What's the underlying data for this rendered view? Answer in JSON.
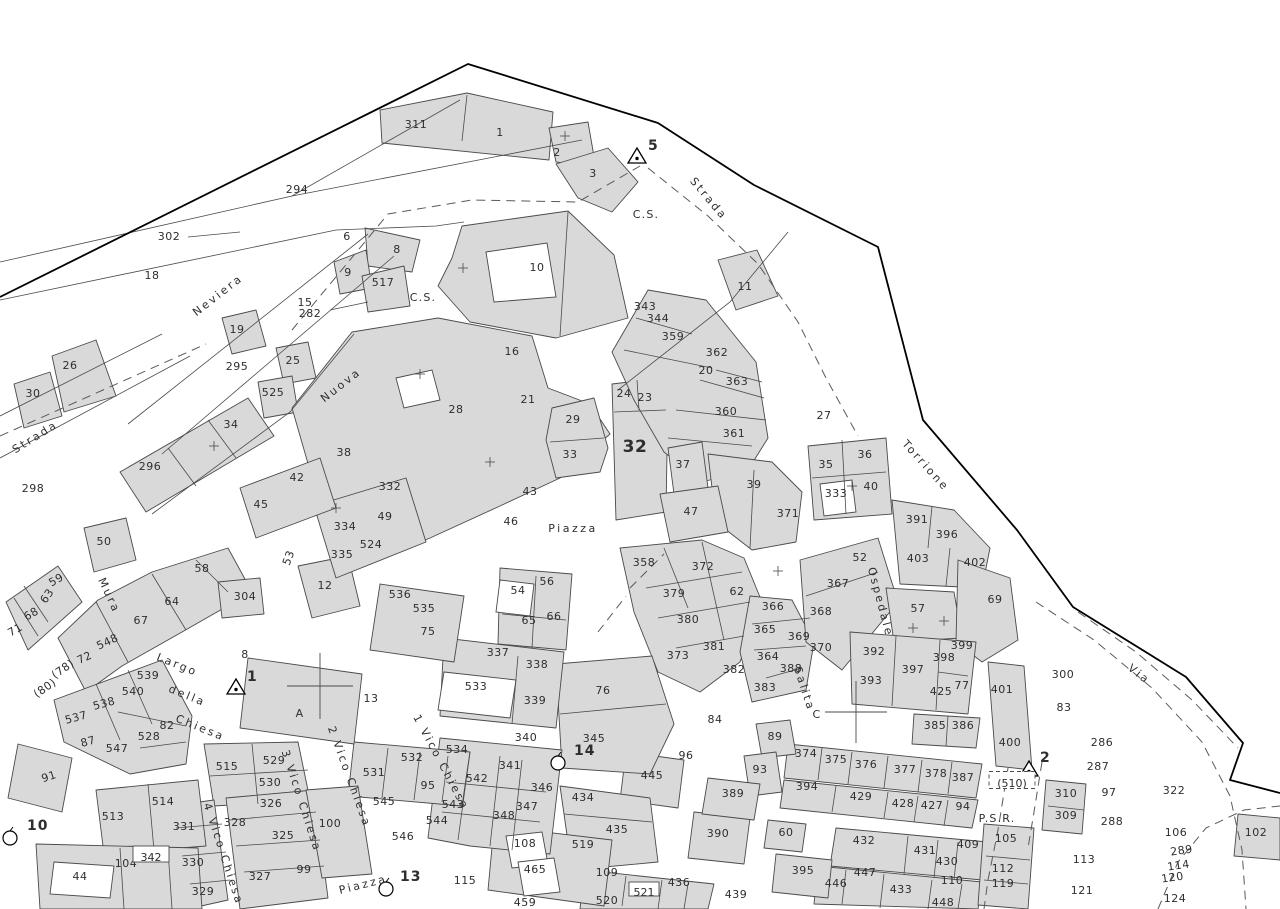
{
  "map": {
    "kind": "cadastral-sheet",
    "colors": {
      "background": "#ffffff",
      "parcel_fill": "#d9d9d9",
      "parcel_line": "#4a4a4a",
      "boundary": "#000000",
      "text": "#2e2e2e",
      "dashed_line": "#5a5a5a"
    },
    "parcel_labels": [
      {
        "t": "311",
        "x": 416,
        "y": 128
      },
      {
        "t": "1",
        "x": 500,
        "y": 136
      },
      {
        "t": "2",
        "x": 557,
        "y": 156
      },
      {
        "t": "3",
        "x": 593,
        "y": 177
      },
      {
        "t": "294",
        "x": 297,
        "y": 193
      },
      {
        "t": "302",
        "x": 169,
        "y": 240
      },
      {
        "t": "18",
        "x": 152,
        "y": 279
      },
      {
        "t": "6",
        "x": 347,
        "y": 240
      },
      {
        "t": "8",
        "x": 397,
        "y": 253
      },
      {
        "t": "9",
        "x": 348,
        "y": 276
      },
      {
        "t": "517",
        "x": 383,
        "y": 286
      },
      {
        "t": "15",
        "x": 305,
        "y": 306
      },
      {
        "t": "282",
        "x": 310,
        "y": 317
      },
      {
        "t": "10",
        "x": 537,
        "y": 271
      },
      {
        "t": "11",
        "x": 745,
        "y": 290
      },
      {
        "t": "19",
        "x": 237,
        "y": 333
      },
      {
        "t": "295",
        "x": 237,
        "y": 370
      },
      {
        "t": "25",
        "x": 293,
        "y": 364
      },
      {
        "t": "525",
        "x": 273,
        "y": 396
      },
      {
        "t": "26",
        "x": 70,
        "y": 369
      },
      {
        "t": "30",
        "x": 33,
        "y": 397
      },
      {
        "t": "34",
        "x": 231,
        "y": 428
      },
      {
        "t": "16",
        "x": 512,
        "y": 355
      },
      {
        "t": "21",
        "x": 528,
        "y": 403
      },
      {
        "t": "28",
        "x": 456,
        "y": 413
      },
      {
        "t": "29",
        "x": 573,
        "y": 423
      },
      {
        "t": "33",
        "x": 570,
        "y": 458
      },
      {
        "t": "24",
        "x": 624,
        "y": 397
      },
      {
        "t": "23",
        "x": 645,
        "y": 401
      },
      {
        "t": "343",
        "x": 645,
        "y": 310
      },
      {
        "t": "344",
        "x": 658,
        "y": 322
      },
      {
        "t": "359",
        "x": 673,
        "y": 340
      },
      {
        "t": "362",
        "x": 717,
        "y": 356
      },
      {
        "t": "20",
        "x": 706,
        "y": 374
      },
      {
        "t": "363",
        "x": 737,
        "y": 385
      },
      {
        "t": "360",
        "x": 726,
        "y": 415
      },
      {
        "t": "361",
        "x": 734,
        "y": 437
      },
      {
        "t": "27",
        "x": 824,
        "y": 419
      },
      {
        "t": "32",
        "x": 635,
        "y": 452,
        "big": true
      },
      {
        "t": "37",
        "x": 683,
        "y": 468
      },
      {
        "t": "39",
        "x": 754,
        "y": 488
      },
      {
        "t": "35",
        "x": 826,
        "y": 468
      },
      {
        "t": "36",
        "x": 865,
        "y": 458
      },
      {
        "t": "333",
        "x": 836,
        "y": 497
      },
      {
        "t": "40",
        "x": 871,
        "y": 490
      },
      {
        "t": "38",
        "x": 344,
        "y": 456
      },
      {
        "t": "42",
        "x": 297,
        "y": 481
      },
      {
        "t": "45",
        "x": 261,
        "y": 508
      },
      {
        "t": "296",
        "x": 150,
        "y": 470
      },
      {
        "t": "298",
        "x": 33,
        "y": 492
      },
      {
        "t": "332",
        "x": 390,
        "y": 490
      },
      {
        "t": "49",
        "x": 385,
        "y": 520
      },
      {
        "t": "334",
        "x": 345,
        "y": 530
      },
      {
        "t": "524",
        "x": 371,
        "y": 548
      },
      {
        "t": "335",
        "x": 342,
        "y": 558
      },
      {
        "t": "53",
        "x": 292,
        "y": 559,
        "r": -70
      },
      {
        "t": "12",
        "x": 325,
        "y": 589
      },
      {
        "t": "50",
        "x": 104,
        "y": 545
      },
      {
        "t": "59",
        "x": 58,
        "y": 583,
        "r": -30
      },
      {
        "t": "63",
        "x": 50,
        "y": 598,
        "r": -55
      },
      {
        "t": "68",
        "x": 33,
        "y": 617,
        "r": -30
      },
      {
        "t": "71",
        "x": 17,
        "y": 633,
        "r": -30
      },
      {
        "t": "58",
        "x": 202,
        "y": 572
      },
      {
        "t": "64",
        "x": 172,
        "y": 605
      },
      {
        "t": "304",
        "x": 245,
        "y": 600
      },
      {
        "t": "67",
        "x": 141,
        "y": 624
      },
      {
        "t": "548",
        "x": 109,
        "y": 645,
        "r": -25
      },
      {
        "t": "72",
        "x": 86,
        "y": 661,
        "r": -25
      },
      {
        "t": "(78)",
        "x": 65,
        "y": 672,
        "r": -35
      },
      {
        "t": "(80)",
        "x": 47,
        "y": 691,
        "r": -35
      },
      {
        "t": "43",
        "x": 530,
        "y": 495
      },
      {
        "t": "46",
        "x": 511,
        "y": 525
      },
      {
        "t": "47",
        "x": 691,
        "y": 515
      },
      {
        "t": "371",
        "x": 788,
        "y": 517
      },
      {
        "t": "358",
        "x": 644,
        "y": 566
      },
      {
        "t": "372",
        "x": 703,
        "y": 570
      },
      {
        "t": "62",
        "x": 737,
        "y": 595
      },
      {
        "t": "379",
        "x": 674,
        "y": 597
      },
      {
        "t": "380",
        "x": 688,
        "y": 623
      },
      {
        "t": "381",
        "x": 714,
        "y": 650
      },
      {
        "t": "373",
        "x": 678,
        "y": 659
      },
      {
        "t": "382",
        "x": 734,
        "y": 673
      },
      {
        "t": "388",
        "x": 791,
        "y": 672
      },
      {
        "t": "383",
        "x": 765,
        "y": 691
      },
      {
        "t": "364",
        "x": 768,
        "y": 660
      },
      {
        "t": "365",
        "x": 765,
        "y": 633
      },
      {
        "t": "366",
        "x": 773,
        "y": 610
      },
      {
        "t": "369",
        "x": 799,
        "y": 640
      },
      {
        "t": "370",
        "x": 821,
        "y": 651
      },
      {
        "t": "368",
        "x": 821,
        "y": 615
      },
      {
        "t": "367",
        "x": 838,
        "y": 587
      },
      {
        "t": "52",
        "x": 860,
        "y": 561
      },
      {
        "t": "57",
        "x": 918,
        "y": 612
      },
      {
        "t": "69",
        "x": 995,
        "y": 603
      },
      {
        "t": "391",
        "x": 917,
        "y": 523
      },
      {
        "t": "396",
        "x": 947,
        "y": 538
      },
      {
        "t": "403",
        "x": 918,
        "y": 562
      },
      {
        "t": "402",
        "x": 975,
        "y": 566
      },
      {
        "t": "392",
        "x": 874,
        "y": 655
      },
      {
        "t": "397",
        "x": 913,
        "y": 673
      },
      {
        "t": "393",
        "x": 871,
        "y": 684
      },
      {
        "t": "399",
        "x": 962,
        "y": 649
      },
      {
        "t": "398",
        "x": 944,
        "y": 661
      },
      {
        "t": "425",
        "x": 941,
        "y": 695
      },
      {
        "t": "77",
        "x": 962,
        "y": 689
      },
      {
        "t": "401",
        "x": 1002,
        "y": 693
      },
      {
        "t": "400",
        "x": 1010,
        "y": 746
      },
      {
        "t": "385",
        "x": 935,
        "y": 729
      },
      {
        "t": "386",
        "x": 963,
        "y": 729
      },
      {
        "t": "300",
        "x": 1063,
        "y": 678
      },
      {
        "t": "83",
        "x": 1064,
        "y": 711
      },
      {
        "t": "286",
        "x": 1102,
        "y": 746
      },
      {
        "t": "287",
        "x": 1098,
        "y": 770
      },
      {
        "t": "310",
        "x": 1066,
        "y": 797
      },
      {
        "t": "97",
        "x": 1109,
        "y": 796
      },
      {
        "t": "322",
        "x": 1174,
        "y": 794
      },
      {
        "t": "309",
        "x": 1066,
        "y": 819
      },
      {
        "t": "288",
        "x": 1112,
        "y": 825
      },
      {
        "t": "106",
        "x": 1176,
        "y": 836
      },
      {
        "t": "102",
        "x": 1256,
        "y": 836
      },
      {
        "t": "289",
        "x": 1182,
        "y": 854,
        "r": -8
      },
      {
        "t": "114",
        "x": 1179,
        "y": 869,
        "r": -8
      },
      {
        "t": "120",
        "x": 1173,
        "y": 881,
        "r": -8
      },
      {
        "t": "113",
        "x": 1084,
        "y": 863
      },
      {
        "t": "121",
        "x": 1082,
        "y": 894
      },
      {
        "t": "124",
        "x": 1175,
        "y": 902
      },
      {
        "t": "105",
        "x": 1006,
        "y": 842
      },
      {
        "t": "112",
        "x": 1003,
        "y": 872
      },
      {
        "t": "110",
        "x": 952,
        "y": 884
      },
      {
        "t": "119",
        "x": 1003,
        "y": 887
      },
      {
        "t": "448",
        "x": 943,
        "y": 906
      },
      {
        "t": "409",
        "x": 968,
        "y": 848
      },
      {
        "t": "430",
        "x": 947,
        "y": 865
      },
      {
        "t": "431",
        "x": 925,
        "y": 854
      },
      {
        "t": "432",
        "x": 864,
        "y": 844
      },
      {
        "t": "447",
        "x": 865,
        "y": 876
      },
      {
        "t": "446",
        "x": 836,
        "y": 887
      },
      {
        "t": "433",
        "x": 901,
        "y": 893
      },
      {
        "t": "60",
        "x": 786,
        "y": 836
      },
      {
        "t": "395",
        "x": 803,
        "y": 874
      },
      {
        "t": "394",
        "x": 807,
        "y": 790
      },
      {
        "t": "429",
        "x": 861,
        "y": 800
      },
      {
        "t": "428",
        "x": 903,
        "y": 807
      },
      {
        "t": "427",
        "x": 932,
        "y": 809
      },
      {
        "t": "94",
        "x": 963,
        "y": 810
      },
      {
        "t": "374",
        "x": 806,
        "y": 757
      },
      {
        "t": "375",
        "x": 836,
        "y": 763
      },
      {
        "t": "376",
        "x": 866,
        "y": 768
      },
      {
        "t": "377",
        "x": 905,
        "y": 773
      },
      {
        "t": "378",
        "x": 936,
        "y": 777
      },
      {
        "t": "387",
        "x": 963,
        "y": 781
      },
      {
        "t": "89",
        "x": 775,
        "y": 740
      },
      {
        "t": "93",
        "x": 760,
        "y": 773
      },
      {
        "t": "96",
        "x": 686,
        "y": 759
      },
      {
        "t": "84",
        "x": 715,
        "y": 723
      },
      {
        "t": "76",
        "x": 603,
        "y": 694
      },
      {
        "t": "345",
        "x": 594,
        "y": 742
      },
      {
        "t": "445",
        "x": 652,
        "y": 779
      },
      {
        "t": "389",
        "x": 733,
        "y": 797
      },
      {
        "t": "390",
        "x": 718,
        "y": 837
      },
      {
        "t": "435",
        "x": 617,
        "y": 833
      },
      {
        "t": "434",
        "x": 583,
        "y": 801
      },
      {
        "t": "436",
        "x": 679,
        "y": 886
      },
      {
        "t": "439",
        "x": 736,
        "y": 898
      },
      {
        "t": "520",
        "x": 607,
        "y": 904
      },
      {
        "t": "109",
        "x": 607,
        "y": 876
      },
      {
        "t": "465",
        "x": 535,
        "y": 873
      },
      {
        "t": "108",
        "x": 525,
        "y": 847
      },
      {
        "t": "519",
        "x": 583,
        "y": 848
      },
      {
        "t": "115",
        "x": 465,
        "y": 884
      },
      {
        "t": "459",
        "x": 525,
        "y": 906
      },
      {
        "t": "542",
        "x": 477,
        "y": 782
      },
      {
        "t": "346",
        "x": 542,
        "y": 791
      },
      {
        "t": "347",
        "x": 527,
        "y": 810
      },
      {
        "t": "348",
        "x": 504,
        "y": 819
      },
      {
        "t": "543",
        "x": 453,
        "y": 808
      },
      {
        "t": "544",
        "x": 437,
        "y": 824
      },
      {
        "t": "545",
        "x": 384,
        "y": 805
      },
      {
        "t": "546",
        "x": 403,
        "y": 840
      },
      {
        "t": "95",
        "x": 428,
        "y": 789
      },
      {
        "t": "531",
        "x": 374,
        "y": 776
      },
      {
        "t": "532",
        "x": 412,
        "y": 761
      },
      {
        "t": "534",
        "x": 457,
        "y": 753
      },
      {
        "t": "341",
        "x": 510,
        "y": 769
      },
      {
        "t": "340",
        "x": 526,
        "y": 741
      },
      {
        "t": "339",
        "x": 535,
        "y": 704
      },
      {
        "t": "533",
        "x": 476,
        "y": 690
      },
      {
        "t": "338",
        "x": 537,
        "y": 668
      },
      {
        "t": "337",
        "x": 498,
        "y": 656
      },
      {
        "t": "66",
        "x": 554,
        "y": 620
      },
      {
        "t": "65",
        "x": 529,
        "y": 624
      },
      {
        "t": "75",
        "x": 428,
        "y": 635
      },
      {
        "t": "535",
        "x": 424,
        "y": 612
      },
      {
        "t": "536",
        "x": 400,
        "y": 598
      },
      {
        "t": "56",
        "x": 547,
        "y": 585
      },
      {
        "t": "54",
        "x": 518,
        "y": 594
      },
      {
        "t": "13",
        "x": 371,
        "y": 702
      },
      {
        "t": "100",
        "x": 330,
        "y": 827
      },
      {
        "t": "326",
        "x": 271,
        "y": 807
      },
      {
        "t": "328",
        "x": 235,
        "y": 826
      },
      {
        "t": "325",
        "x": 283,
        "y": 839
      },
      {
        "t": "99",
        "x": 304,
        "y": 873
      },
      {
        "t": "327",
        "x": 260,
        "y": 880
      },
      {
        "t": "330",
        "x": 193,
        "y": 866
      },
      {
        "t": "329",
        "x": 203,
        "y": 895
      },
      {
        "t": "331",
        "x": 184,
        "y": 830
      },
      {
        "t": "515",
        "x": 227,
        "y": 770
      },
      {
        "t": "529",
        "x": 274,
        "y": 764
      },
      {
        "t": "530",
        "x": 270,
        "y": 786
      },
      {
        "t": "513",
        "x": 113,
        "y": 820
      },
      {
        "t": "514",
        "x": 163,
        "y": 805
      },
      {
        "t": "104",
        "x": 126,
        "y": 867
      },
      {
        "t": "44",
        "x": 80,
        "y": 880
      },
      {
        "t": "91",
        "x": 50,
        "y": 780,
        "r": -18
      },
      {
        "t": "537",
        "x": 77,
        "y": 721,
        "r": -15
      },
      {
        "t": "538",
        "x": 105,
        "y": 707,
        "r": -15
      },
      {
        "t": "539",
        "x": 148,
        "y": 679
      },
      {
        "t": "540",
        "x": 133,
        "y": 695
      },
      {
        "t": "82",
        "x": 167,
        "y": 729
      },
      {
        "t": "528",
        "x": 149,
        "y": 740
      },
      {
        "t": "87",
        "x": 89,
        "y": 745,
        "r": -15
      },
      {
        "t": "547",
        "x": 117,
        "y": 752
      },
      {
        "t": "8",
        "x": 245,
        "y": 658
      }
    ],
    "boxed_labels": [
      {
        "t": "342",
        "x": 151,
        "y": 858,
        "w": 36,
        "h": 16,
        "dashed": false
      },
      {
        "t": "521",
        "x": 644,
        "y": 893,
        "w": 30,
        "h": 14,
        "dashed": false
      },
      {
        "t": "(510)",
        "x": 1012,
        "y": 784,
        "w": 46,
        "h": 17,
        "dashed": true
      }
    ],
    "area_labels": [
      {
        "t": "C.S.",
        "x": 646,
        "y": 218
      },
      {
        "t": "C.S.",
        "x": 423,
        "y": 301
      },
      {
        "t": "A",
        "x": 300,
        "y": 717
      },
      {
        "t": "C",
        "x": 817,
        "y": 718
      },
      {
        "t": "P.S.R.",
        "x": 997,
        "y": 822
      }
    ],
    "street_labels": [
      {
        "t": "Strada",
        "x": 706,
        "y": 201,
        "r": 50
      },
      {
        "t": "Neviera",
        "x": 220,
        "y": 298,
        "r": -38
      },
      {
        "t": "Strada",
        "x": 37,
        "y": 440,
        "r": -32
      },
      {
        "t": "Nuova",
        "x": 343,
        "y": 388,
        "r": -38
      },
      {
        "t": "Mura",
        "x": 106,
        "y": 597,
        "r": 65
      },
      {
        "t": "Largo",
        "x": 176,
        "y": 668,
        "r": 22
      },
      {
        "t": "della",
        "x": 186,
        "y": 699,
        "r": 22
      },
      {
        "t": "Chiesa",
        "x": 199,
        "y": 731,
        "r": 22
      },
      {
        "t": "Torrione",
        "x": 923,
        "y": 468,
        "r": 48
      },
      {
        "t": "Ospedale",
        "x": 877,
        "y": 603,
        "r": 75
      },
      {
        "t": "Salita",
        "x": 801,
        "y": 690,
        "r": 72
      },
      {
        "t": "Via",
        "x": 1137,
        "y": 677,
        "r": 38
      },
      {
        "t": "Piazza",
        "x": 573,
        "y": 532,
        "r": 0
      },
      {
        "t": "Piazza",
        "x": 364,
        "y": 888,
        "r": -14
      },
      {
        "t": "1 Vico Chiesa",
        "x": 438,
        "y": 764,
        "r": 62
      },
      {
        "t": "2 Vico Chiesa",
        "x": 346,
        "y": 778,
        "r": 70
      },
      {
        "t": "3 Vico Chiesa",
        "x": 298,
        "y": 802,
        "r": 72
      },
      {
        "t": "4 Vico Chiesa",
        "x": 220,
        "y": 855,
        "r": 72
      }
    ],
    "survey_points": [
      {
        "id": "5",
        "shape": "triangle",
        "x": 637,
        "y": 157,
        "lx": 648,
        "ly": 150
      },
      {
        "id": "1",
        "shape": "triangle",
        "x": 236,
        "y": 688,
        "lx": 247,
        "ly": 681
      },
      {
        "id": "2",
        "shape": "triangle",
        "x": 1029,
        "y": 770,
        "lx": 1040,
        "ly": 762
      },
      {
        "id": "10",
        "shape": "circle",
        "x": 10,
        "y": 838,
        "lx": 27,
        "ly": 830
      },
      {
        "id": "14",
        "shape": "circle",
        "x": 558,
        "y": 763,
        "lx": 574,
        "ly": 755
      },
      {
        "id": "13",
        "shape": "circle",
        "x": 386,
        "y": 889,
        "lx": 400,
        "ly": 881
      }
    ]
  }
}
